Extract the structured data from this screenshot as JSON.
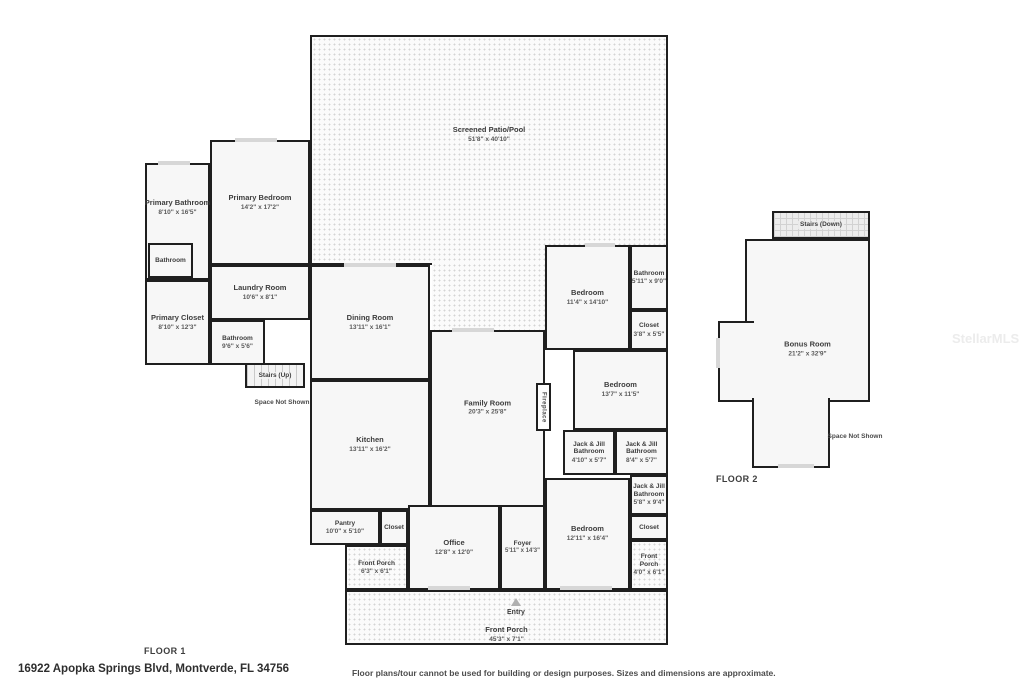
{
  "floor1": {
    "label": "FLOOR 1",
    "space_not_shown": "Space Not Shown",
    "entry_label": "Entry",
    "rooms": {
      "screened_patio": {
        "name": "Screened Patio/Pool",
        "dims": "51'8\" x 40'10\""
      },
      "primary_bathroom": {
        "name": "Primary Bathroom",
        "dims": "8'10\" x 16'5\""
      },
      "primary_bedroom": {
        "name": "Primary Bedroom",
        "dims": "14'2\" x 17'2\""
      },
      "toilet_room": {
        "name": "Bathroom",
        "dims": ""
      },
      "primary_closet": {
        "name": "Primary Closet",
        "dims": "8'10\" x 12'3\""
      },
      "laundry_room": {
        "name": "Laundry Room",
        "dims": "10'6\" x 8'1\""
      },
      "hall_bathroom": {
        "name": "Bathroom",
        "dims": "9'6\" x 5'6\""
      },
      "stairs_up": {
        "name": "Stairs (Up)",
        "dims": ""
      },
      "dining_room": {
        "name": "Dining Room",
        "dims": "13'11\" x 16'1\""
      },
      "kitchen": {
        "name": "Kitchen",
        "dims": "13'11\" x 16'2\""
      },
      "family_room": {
        "name": "Family Room",
        "dims": "20'3\" x 25'8\""
      },
      "fireplace": {
        "name": "Fireplace",
        "dims": ""
      },
      "bedroom_2": {
        "name": "Bedroom",
        "dims": "11'4\" x 14'10\""
      },
      "bathroom_2": {
        "name": "Bathroom",
        "dims": "5'11\" x 9'0\""
      },
      "closet_2": {
        "name": "Closet",
        "dims": "3'8\" x 5'5\""
      },
      "bedroom_3": {
        "name": "Bedroom",
        "dims": "13'7\" x 11'5\""
      },
      "jack_jill_bathroom_a": {
        "name": "Jack & Jill Bathroom",
        "dims": "4'10\" x 5'7\""
      },
      "jack_jill_bathroom_b": {
        "name": "Jack & Jill Bathroom",
        "dims": "8'4\" x 5'7\""
      },
      "jack_jill_bathroom_c": {
        "name": "Jack & Jill Bathroom",
        "dims": "5'8\" x 9'4\""
      },
      "closet_3": {
        "name": "Closet",
        "dims": ""
      },
      "bedroom_4": {
        "name": "Bedroom",
        "dims": "12'11\" x 16'4\""
      },
      "front_porch_right": {
        "name": "Front Porch",
        "dims": "4'0\" x 6'1\""
      },
      "pantry": {
        "name": "Pantry",
        "dims": "10'0\" x 5'10\""
      },
      "closet_hall": {
        "name": "Closet",
        "dims": ""
      },
      "office": {
        "name": "Office",
        "dims": "12'8\" x 12'0\""
      },
      "foyer": {
        "name": "Foyer",
        "dims": "5'11\" x 14'3\""
      },
      "front_porch_left": {
        "name": "Front Porch",
        "dims": "6'3\" x 6'1\""
      },
      "front_porch_main": {
        "name": "Front Porch",
        "dims": "45'3\" x 7'1\""
      }
    }
  },
  "floor2": {
    "label": "FLOOR 2",
    "space_not_shown": "Space Not Shown",
    "rooms": {
      "stairs_down": {
        "name": "Stairs (Down)",
        "dims": ""
      },
      "bonus_room": {
        "name": "Bonus Room",
        "dims": "21'2\" x 32'9\""
      }
    }
  },
  "footer": {
    "address": "16922 Apopka Springs Blvd, Montverde, FL 34756",
    "disclaimer": "Floor plans/tour cannot be used for building or design purposes. Sizes and dimensions are approximate."
  },
  "watermark": "StellarMLS",
  "colors": {
    "wall": "#1f1f1f",
    "room_fill": "#f7f7f7",
    "pattern_dot": "#d4d4d4",
    "window": "#d7d7d7"
  }
}
